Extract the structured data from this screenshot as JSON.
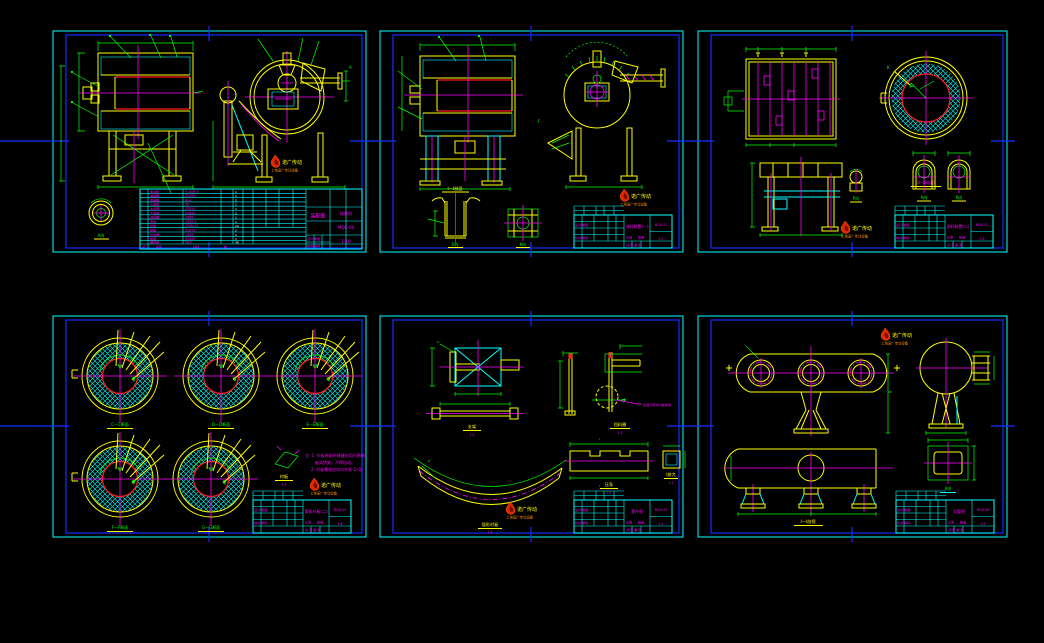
{
  "palette": {
    "background": "#000000",
    "frame_blue": "#1430ff",
    "paper_cyan": "#00ffff",
    "line_yellow": "#ffff00",
    "line_green": "#00ff00",
    "line_magenta": "#ff00ff",
    "line_red": "#ff1a1a",
    "logo_orange": "#ff8c00",
    "text_white": "#ffffff"
  },
  "logo": {
    "line1": "诺广传动",
    "line2": "上海诺广传动设备"
  },
  "titleblock_labels": {
    "sig_row1": "设计 制图",
    "sig_row2": "校对 审核",
    "scale_label": "比例",
    "qty_label": "数量",
    "sheet_label": "共 张 第 张"
  },
  "sheets": [
    {
      "title": "装配图",
      "product": "球磨机",
      "dwg_no": "MQG-00",
      "scale": "1:10",
      "detail_label": "A向",
      "parts_header": {
        "no": "序",
        "name": "名称",
        "spec": "材料",
        "qty": "数"
      },
      "parts": [
        {
          "name": "电动机",
          "spec": "Y160M-4",
          "qty": "1"
        },
        {
          "name": "减速器",
          "spec": "ZQ350",
          "qty": "1"
        },
        {
          "name": "联轴器",
          "spec": "HL4",
          "qty": "2"
        },
        {
          "name": "小齿轮",
          "spec": "45",
          "qty": "1"
        },
        {
          "name": "大齿圈",
          "spec": "ZG310",
          "qty": "1"
        },
        {
          "name": "主轴承",
          "spec": "HT200",
          "qty": "2"
        },
        {
          "name": "进料器",
          "spec": "Q235",
          "qty": "1"
        },
        {
          "name": "筒体",
          "spec": "Q235-A",
          "qty": "1"
        },
        {
          "name": "衬板",
          "spec": "ZGMn13",
          "qty": "24"
        },
        {
          "name": "端盖",
          "spec": "ZG270",
          "qty": "2"
        },
        {
          "name": "出料器",
          "spec": "Q235",
          "qty": "1"
        },
        {
          "name": "机座",
          "spec": "HT150",
          "qty": "1"
        },
        {
          "name": "螺栓组",
          "spec": "M20",
          "qty": "48"
        }
      ]
    },
    {
      "title": "进料装置(一)",
      "dwg_no": "MQG-01",
      "scale": "1:5",
      "section_top": "Ⅰ—Ⅰ剖面",
      "view_d": "D向",
      "view_k": "K向"
    },
    {
      "title": "进料装置(二)",
      "dwg_no": "MQG-02",
      "scale": "1:5",
      "section_b": "B—B剖面",
      "view_p": "P向",
      "arch_a": "A向",
      "arch_k": "K向",
      "expand": "展开图"
    },
    {
      "title": "筒体衬板(二)",
      "dwg_no": "MQG-04",
      "scale": "1:8",
      "sections": [
        "C—C断面",
        "D—D断面",
        "E—E断面",
        "F—F断面",
        "G—G断面"
      ],
      "detail_label": "衬板",
      "detail_scale": "1:5",
      "notes": [
        "注: 1. 衬板装配时接缝处用石棉绳",
        "嵌实挤紧，不得松动。",
        "2. 衬板螺栓应均匀拧紧 Q-Q。"
      ]
    },
    {
      "title": "零件图",
      "dwg_no": "MQG-05",
      "scale": "1:2",
      "labels": [
        "支架",
        "托板",
        "弧形衬板",
        "挡料圈",
        "压条",
        "Ⅰ放大"
      ],
      "sublabels": [
        "1:2",
        "1:2",
        "1:4",
        "1:2",
        "1:2",
        "1:1"
      ],
      "weld_note": "弧面与筒体内壁焊接"
    },
    {
      "title": "风管图",
      "dwg_no": "MQG-06",
      "scale": "1:5",
      "bottom_label": "Ⅰ—Ⅰ剖视",
      "flange_label": "A向"
    }
  ]
}
